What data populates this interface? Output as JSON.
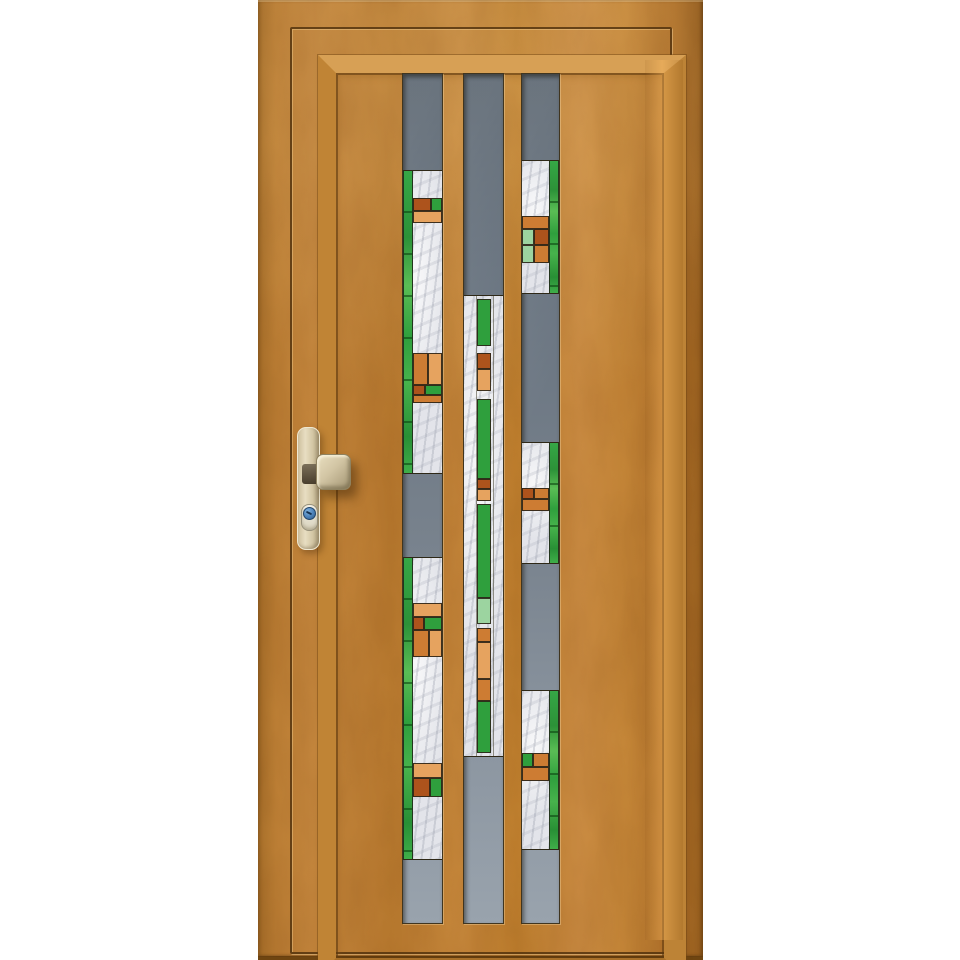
{
  "scene_label": "Golden oak wooden front entry door with three vertical glazing strips of gray and art-deco stained glass, champagne handle and blue lock cylinder, on white background",
  "door": {
    "palette": {
      "wood_golden_oak": "#c08236",
      "wood_shadow": "#9c6320",
      "wood_highlight": "#d7a055",
      "glass_gray_top": "#59646f",
      "glass_gray_bottom": "#99a3ad",
      "marble_white": "#e9eaee",
      "green": "#2f9f3d",
      "light_green": "#9cd4a0",
      "rust": "#ad531c",
      "orange": "#cd7c33",
      "light_orange": "#e6a35f",
      "lead_line": "#2e2817",
      "metal_champagne": "#d6c9a8",
      "lock_cylinder_blue": "#4a80b8"
    },
    "slab": {
      "x": 258,
      "y": 0,
      "w": 445,
      "h": 956
    },
    "groove": {
      "x": 290,
      "y": 27,
      "w": 378,
      "h": 923
    },
    "molding": {
      "x": 318,
      "y": 55,
      "w": 328,
      "h": 885
    },
    "highlight_band": {
      "x": 645,
      "y": 60,
      "w": 38,
      "h": 880
    },
    "glass": {
      "top": 73,
      "height": 849,
      "strips": [
        {
          "name": "left",
          "x": 402,
          "w": 39,
          "green_edge": "left",
          "sections": [
            {
              "type": "gray",
              "y": 73,
              "h": 97
            },
            {
              "type": "stained",
              "y": 170,
              "h": 302,
              "mosaics": [
                {
                  "y": 197,
                  "rows": [
                    {
                      "h": 13,
                      "cells": [
                        {
                          "c": "rust",
                          "f": 62
                        },
                        {
                          "c": "green",
                          "f": 38
                        }
                      ]
                    },
                    {
                      "h": 12,
                      "cells": [
                        {
                          "c": "lorange",
                          "f": 100
                        }
                      ]
                    }
                  ]
                },
                {
                  "y": 352,
                  "rows": [
                    {
                      "h": 32,
                      "cells": [
                        {
                          "c": "orange",
                          "f": 52
                        },
                        {
                          "c": "lorange",
                          "f": 48
                        }
                      ]
                    },
                    {
                      "h": 10,
                      "cells": [
                        {
                          "c": "rust",
                          "f": 38
                        },
                        {
                          "c": "green",
                          "f": 62
                        }
                      ]
                    },
                    {
                      "h": 8,
                      "cells": [
                        {
                          "c": "orange",
                          "f": 100
                        }
                      ]
                    }
                  ]
                }
              ]
            },
            {
              "type": "gray",
              "y": 472,
              "h": 85
            },
            {
              "type": "stained",
              "y": 557,
              "h": 301,
              "mosaics": [
                {
                  "y": 602,
                  "rows": [
                    {
                      "h": 14,
                      "cells": [
                        {
                          "c": "lorange",
                          "f": 100
                        }
                      ]
                    },
                    {
                      "h": 13,
                      "cells": [
                        {
                          "c": "rust",
                          "f": 35
                        },
                        {
                          "c": "green",
                          "f": 65
                        }
                      ]
                    },
                    {
                      "h": 27,
                      "cells": [
                        {
                          "c": "orange",
                          "f": 55
                        },
                        {
                          "c": "lorange",
                          "f": 45
                        }
                      ]
                    }
                  ]
                },
                {
                  "y": 762,
                  "rows": [
                    {
                      "h": 15,
                      "cells": [
                        {
                          "c": "lorange",
                          "f": 100
                        }
                      ]
                    },
                    {
                      "h": 19,
                      "cells": [
                        {
                          "c": "rust",
                          "f": 60
                        },
                        {
                          "c": "green",
                          "f": 40
                        }
                      ]
                    }
                  ]
                }
              ]
            },
            {
              "type": "gray",
              "y": 858,
              "h": 64
            }
          ]
        },
        {
          "name": "center",
          "x": 463,
          "w": 39,
          "green_edge": "center",
          "sections": [
            {
              "type": "gray",
              "y": 73,
              "h": 222
            },
            {
              "type": "stained",
              "y": 295,
              "h": 460,
              "column": {
                "x": 13,
                "w": 14,
                "segments": [
                  {
                    "y": 298,
                    "h": 47,
                    "c": "green"
                  },
                  {
                    "y": 352,
                    "h": 16,
                    "c": "rust"
                  },
                  {
                    "y": 368,
                    "h": 22,
                    "c": "lorange"
                  },
                  {
                    "y": 398,
                    "h": 80,
                    "c": "green"
                  },
                  {
                    "y": 478,
                    "h": 10,
                    "c": "rust"
                  },
                  {
                    "y": 488,
                    "h": 12,
                    "c": "lorange"
                  },
                  {
                    "y": 503,
                    "h": 94,
                    "c": "green"
                  },
                  {
                    "y": 597,
                    "h": 26,
                    "c": "ltgreen"
                  },
                  {
                    "y": 627,
                    "h": 14,
                    "c": "orange"
                  },
                  {
                    "y": 641,
                    "h": 37,
                    "c": "lorange"
                  },
                  {
                    "y": 678,
                    "h": 22,
                    "c": "orange"
                  },
                  {
                    "y": 700,
                    "h": 52,
                    "c": "green"
                  }
                ]
              }
            },
            {
              "type": "gray",
              "y": 755,
              "h": 167
            }
          ]
        },
        {
          "name": "right",
          "x": 521,
          "w": 37,
          "green_edge": "right",
          "sections": [
            {
              "type": "gray",
              "y": 73,
              "h": 87
            },
            {
              "type": "stained",
              "y": 160,
              "h": 132,
              "mosaics": [
                {
                  "y": 215,
                  "rows": [
                    {
                      "h": 13,
                      "cells": [
                        {
                          "c": "orange",
                          "f": 100
                        }
                      ]
                    },
                    {
                      "h": 16,
                      "cells": [
                        {
                          "c": "ltgreen",
                          "f": 45
                        },
                        {
                          "c": "rust",
                          "f": 55
                        }
                      ]
                    },
                    {
                      "h": 18,
                      "cells": [
                        {
                          "c": "ltgreen",
                          "f": 45
                        },
                        {
                          "c": "orange",
                          "f": 55
                        }
                      ]
                    }
                  ]
                }
              ]
            },
            {
              "type": "gray",
              "y": 292,
              "h": 150
            },
            {
              "type": "stained",
              "y": 442,
              "h": 120,
              "mosaics": [
                {
                  "y": 487,
                  "rows": [
                    {
                      "h": 11,
                      "cells": [
                        {
                          "c": "rust",
                          "f": 42
                        },
                        {
                          "c": "orange",
                          "f": 58
                        }
                      ]
                    },
                    {
                      "h": 12,
                      "cells": [
                        {
                          "c": "orange",
                          "f": 100
                        }
                      ]
                    }
                  ]
                }
              ]
            },
            {
              "type": "gray",
              "y": 562,
              "h": 128
            },
            {
              "type": "stained",
              "y": 690,
              "h": 158,
              "mosaics": [
                {
                  "y": 752,
                  "rows": [
                    {
                      "h": 14,
                      "cells": [
                        {
                          "c": "green",
                          "f": 38
                        },
                        {
                          "c": "orange",
                          "f": 62
                        }
                      ]
                    },
                    {
                      "h": 14,
                      "cells": [
                        {
                          "c": "orange",
                          "f": 100
                        }
                      ]
                    }
                  ]
                }
              ]
            },
            {
              "type": "gray",
              "y": 848,
              "h": 74
            }
          ]
        }
      ]
    },
    "handle": {
      "plate": {
        "x": 297,
        "y": 427,
        "w": 21,
        "h": 121
      },
      "neck": {
        "x": 302,
        "y": 464,
        "w": 18,
        "h": 20
      },
      "knob": {
        "x": 316,
        "y": 454,
        "w": 33,
        "h": 34
      },
      "escutcheon": {
        "x": 301,
        "y": 504,
        "w": 15,
        "h": 25
      },
      "cylinder": {
        "x": 303,
        "y": 507,
        "w": 11,
        "h": 11
      }
    }
  }
}
